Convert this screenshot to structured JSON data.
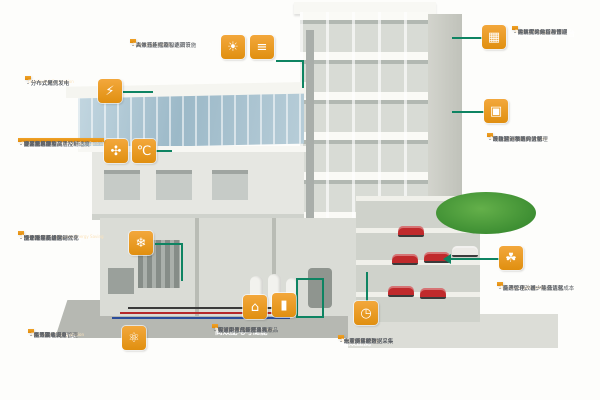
{
  "colors": {
    "accent_orange": "#e8940f",
    "line_green": "#0e8462",
    "pipe_red": "#b5282a",
    "pipe_blue": "#2b4d9b",
    "glass_blue": "#9cb9c8",
    "lawn_green": "#3e8f33",
    "car_red": "#c02a2c"
  },
  "blocks": {
    "distributed_generation": {
      "title": "分布式发电",
      "subtitle": "Distributed Generation",
      "items": [
        "分布式光伏发电",
        "分布式燃气发电",
        "分布式风力发电"
      ]
    },
    "hvac_control": {
      "title": "暖通空调系统控制",
      "subtitle": "Air Conditioning System Demand Control",
      "items": [
        "提高室内空气品质及舒适度",
        "过滤器堵塞监测",
        "分区域温湿度灵活控制",
        "空调机组群控",
        "高效风机控制",
        "变风量系统"
      ]
    },
    "chiller_plant": {
      "title": "高效制冷供热系统",
      "subtitle": "Cooling & Heating System Energy Saving",
      "items": [
        "优化冷水机组运行效率",
        "冷却塔制冷优化",
        "冷冻水泵变频控制",
        "水系统平衡",
        "锅炉群控节能",
        "整个冷热系统联动优化"
      ]
    },
    "energy_station": {
      "title": "分布式能源站",
      "subtitle": "Distributed Energy Station",
      "items": [
        "蓄冷蓄热设备",
        "燃气发电",
        "余热回收发电",
        "能源联动调节",
        "能源集成调度管理"
      ]
    },
    "lighting_shading": {
      "title": "照明与遮阳",
      "subtitle": "Lighting & Curtains",
      "items": [
        "高效节能光源和遮阳设施",
        "自然光补偿及智能调节",
        "人体感应控制"
      ]
    },
    "power_distribution": {
      "title": "高效配电与储能",
      "subtitle": "Power Distribution & Storage",
      "items": [
        "集成配电气化产品包",
        "智能中压、低压全线产品",
        "先进电力储能技术亮点",
        "预制化产品和解决方案",
        "实时高效的能源转换"
      ]
    },
    "energy_monitoring": {
      "title": "能效监测",
      "subtitle": "Energy Monitoring",
      "items": [
        "电能质量管理",
        "一次侧实时数据采集",
        "二次侧实时数据采集",
        "水量、热量数据采集",
        "分项能耗统计"
      ]
    },
    "energy_platform": {
      "title": "建筑能效管理平台",
      "subtitle": "Building Energy System",
      "items": [
        "建筑群的运营与管理",
        "大数据采集和存储",
        "能耗实时分析和预测",
        "持续优化的运营方案"
      ]
    },
    "building_automation": {
      "title": "楼宇自控系统",
      "subtitle": "Building Automation System",
      "items": [
        "环境监测参数的监测",
        "设备运行状况实时管理",
        "故障预测和统计分析",
        "系统联动策略的优化"
      ]
    },
    "operation_optimization": {
      "title": "运营优化",
      "subtitle": "Operation Optimization",
      "items": [
        "能源优化，减少能源消耗",
        "系统管理，统一平台优化",
        "资产管理改善，降低运营成本"
      ]
    }
  },
  "icons": {
    "generator": "⚡",
    "fan": "✣",
    "thermometer": "℃",
    "snowflake": "❄",
    "molecule": "⚛",
    "sun": "☀",
    "blinds": "≡",
    "transformer": "⌂",
    "battery": "▮",
    "meter": "◷",
    "dashboard": "▦",
    "building_grid": "▣",
    "leaf": "☘"
  }
}
